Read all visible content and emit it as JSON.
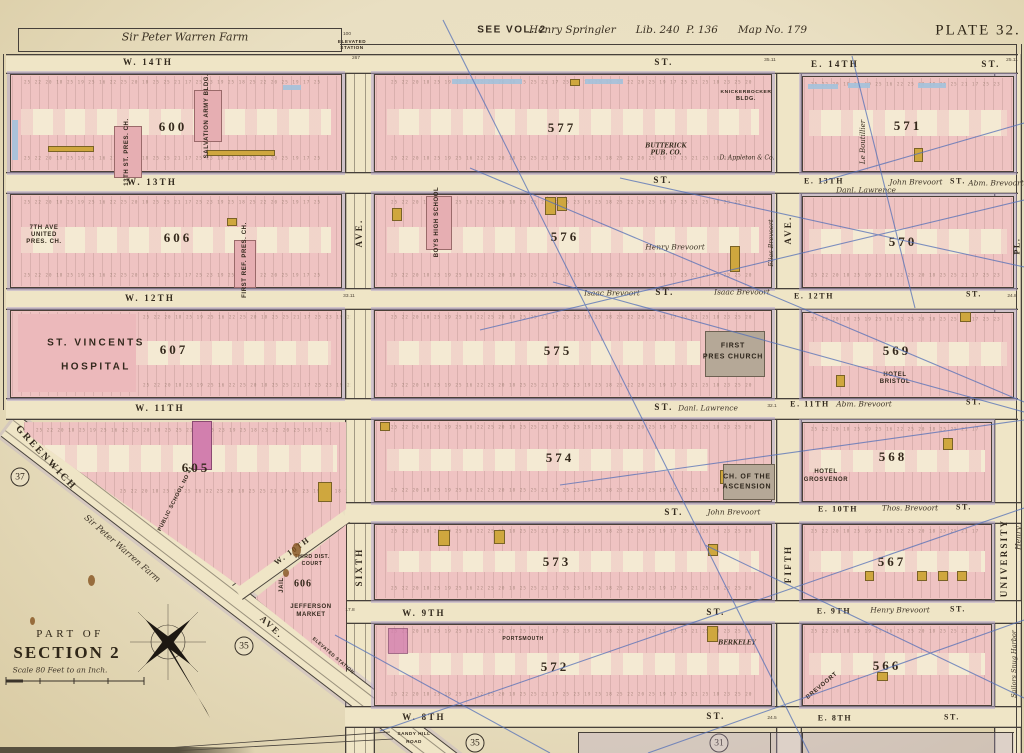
{
  "header": {
    "farm_top": "Sir Peter Warren Farm",
    "see_vol": "SEE VOL. 2",
    "deed_note": "Henry Springler      Lib. 240  P. 136      Map No. 179",
    "plate": "PLATE 32.",
    "elevated_a": "ELEVATED",
    "elevated_b": "STATION",
    "elevated_diag": "ELEVATED STATION"
  },
  "corner": {
    "part_of": "PART OF",
    "section": "SECTION 2",
    "scale": "Scale 80 Feet to an Inch."
  },
  "plate_refs": {
    "left": "37",
    "mid": "35",
    "bottom_left": "35",
    "bottom_right": "31"
  },
  "streets": {
    "w14": "W. 14TH",
    "w14_st": "ST.",
    "e14": "E. 14TH",
    "e14_st": "ST.",
    "w13": "W. 13TH",
    "w13_st": "ST.",
    "e13": "E. 13TH",
    "e13_st": "ST.",
    "w12": "W. 12TH",
    "w12_st": "ST.",
    "e12": "E. 12TH",
    "e12_st": "ST.",
    "w11": "W. 11TH",
    "w11_st": "ST.",
    "e11": "E. 11TH",
    "e11_st": "ST.",
    "w10_diag": "W. 10TH",
    "st10_mid": "ST.",
    "e10": "E. 10TH",
    "e10_st": "ST.",
    "w9": "W. 9TH",
    "w9_st": "ST.",
    "e9": "E. 9TH",
    "e9_st": "ST.",
    "w8": "W. 8TH",
    "w8_st": "ST.",
    "e8": "E. 8TH",
    "e8_st": "ST.",
    "sandy_a": "SANDY HILL",
    "sandy_b": "ROAD"
  },
  "owners": {
    "e13_a": "Danl. Lawrence",
    "e13_b": "John Brevoort",
    "e13_c": "Abm. Brevoort",
    "mid12_a": "Isaac Brevoort",
    "mid12_b": "Isaac Brevoort",
    "mid11": "Danl. Lawrence",
    "e11": "Abm. Brevoort",
    "mid10": "John Brevoort",
    "e10": "Thos. Brevoort",
    "e9": "Henry Brevoort",
    "b576": "Henry Brevoort",
    "b576_side": "Elias Brevoort",
    "farm_diag": "Sir Peter Warren Farm",
    "snug": "Sailors Snug Harbor",
    "henry_edge": "Henry"
  },
  "avenues": {
    "greenwich": "GREENWICH",
    "greenwich_ave": "AVE.",
    "sixth": "SIXTH",
    "sixth_ave": "AVE.",
    "fifth": "FIFTH",
    "fifth_ave": "AVE.",
    "university": "UNIVERSITY",
    "pl": "PL."
  },
  "blocks": {
    "b600": {
      "num": "600"
    },
    "b577": {
      "num": "577"
    },
    "b571": {
      "num": "571"
    },
    "b606": {
      "num": "606"
    },
    "b576": {
      "num": "576"
    },
    "b570": {
      "num": "570"
    },
    "b607": {
      "num": "607"
    },
    "b575": {
      "num": "575"
    },
    "b569": {
      "num": "569"
    },
    "b605": {
      "num": "605"
    },
    "b574": {
      "num": "574"
    },
    "b568": {
      "num": "568"
    },
    "b573": {
      "num": "573"
    },
    "b567": {
      "num": "567"
    },
    "b572": {
      "num": "572"
    },
    "b566": {
      "num": "566"
    },
    "jeff": {
      "num": "606"
    }
  },
  "buildings": {
    "pres13": "13TH ST. PRES. CH.",
    "salvation": "SALVATION ARMY BLDG.",
    "butterick1": "BUTTERICK",
    "butterick2": "PUB. CO.",
    "knick1": "KNICKERBOCKER",
    "knick2": "BLDG.",
    "appleton": "D. Appleton & Co.",
    "leboutillier": "Le Boutillier",
    "pres7_1": "7TH AVE",
    "pres7_2": "UNITED",
    "pres7_3": "PRES. CH.",
    "first_ref": "FIRST REF. PRES. CH.",
    "boys": "BOYS HIGH SCHOOL",
    "stv1": "ST. VINCENTS",
    "stv2": "HOSPITAL",
    "first_pres1": "FIRST",
    "first_pres2": "PRES CHURCH",
    "bristol1": "HOTEL",
    "bristol2": "BRISTOL",
    "ps41": "PUBLIC SCHOOL NO 41",
    "ascension1": "CH. OF THE",
    "ascension2": "ASCENSION",
    "grosvenor1": "HOTEL",
    "grosvenor2": "GROSVENOR",
    "court1": "THIRD DIST.",
    "court2": "COURT",
    "jail": "JAIL",
    "market1": "JEFFERSON",
    "market2": "MARKET",
    "portsmouth": "PORTSMOUTH",
    "berkeley": "BERKELEY",
    "brevoort_hotel": "BREVOORT"
  },
  "dims": {
    "d267": "267",
    "d100": "100",
    "d3511": "35.11",
    "d2511": "25.11",
    "d3311": "33.11",
    "d321": "32.1",
    "d178": "17.8",
    "d245": "24.5",
    "d248": "24.8"
  },
  "noise": "25 22 20 18 25 19 25 16 22 25 20 18 25 25 21 17 25 23 19 25 18 25 22 20 25 19 17 25 21 25 18 23 25 20 25 22 18 25 19 25 20 22 18 25 19 25 16 22 25 20",
  "palette": {
    "paper": "#e9dfc2",
    "street": "#efe5c6",
    "block_pink": "#efc3c2",
    "yard_cream": "#f4ead3",
    "lavender": "#b2a2ce",
    "gold": "#cfa73e",
    "blue_line": "#5470b8",
    "water_blue": "#a3c2dc",
    "church_gray": "#b5a897",
    "magenta": "#d27fae",
    "ink": "#33291d"
  }
}
